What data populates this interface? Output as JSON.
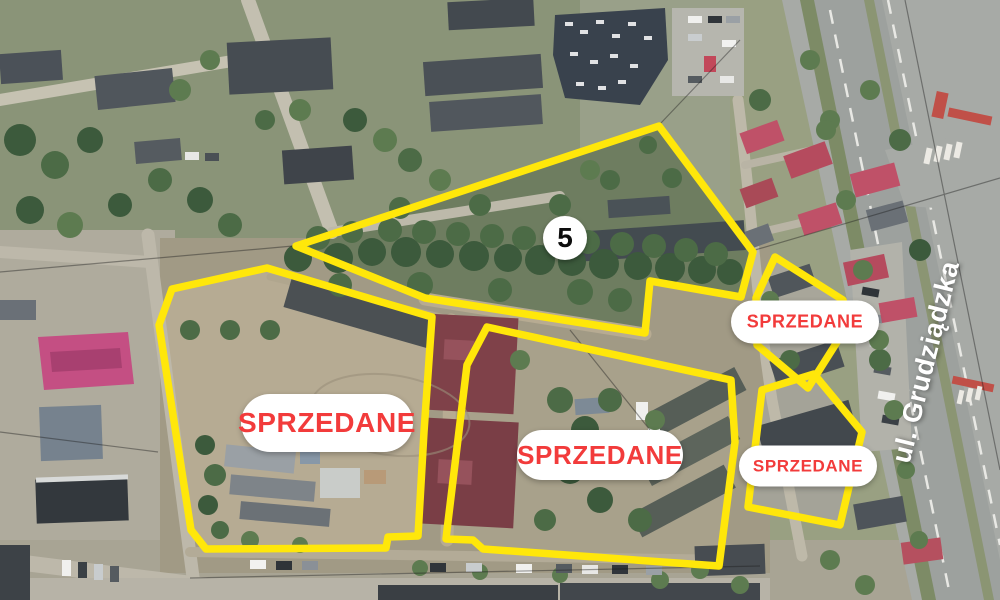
{
  "overlay": {
    "street_label": "ul. Grudziądzka",
    "outline_color": "#FFE70A",
    "sold_text_color": "#F23B3B",
    "pill_background": "#FFFFFF",
    "marker_background": "#FFFFFF"
  },
  "parcels": [
    {
      "id": "plot-5",
      "marker_label": "5",
      "points": "296,246 659,126 753,252 741,297 650,281 645,333 425,298"
    },
    {
      "id": "plot-left",
      "label": "SPRZEDANE",
      "points": "172,289 267,268 432,317 424,432 418,536 388,537 386,548 206,549 191,530 159,325"
    },
    {
      "id": "plot-middle",
      "label": "SPRZEDANE",
      "points": "487,327 731,380 735,442 719,566 483,549 473,540 446,539 447,530 467,365"
    },
    {
      "id": "plot-top-right",
      "label": "SPRZEDANE",
      "points": "775,257 843,300 849,323 808,388 757,345 756,298"
    },
    {
      "id": "plot-bottom-right",
      "label": "SPRZEDANE",
      "points": "762,390 814,374 862,432 840,525 748,507"
    }
  ]
}
